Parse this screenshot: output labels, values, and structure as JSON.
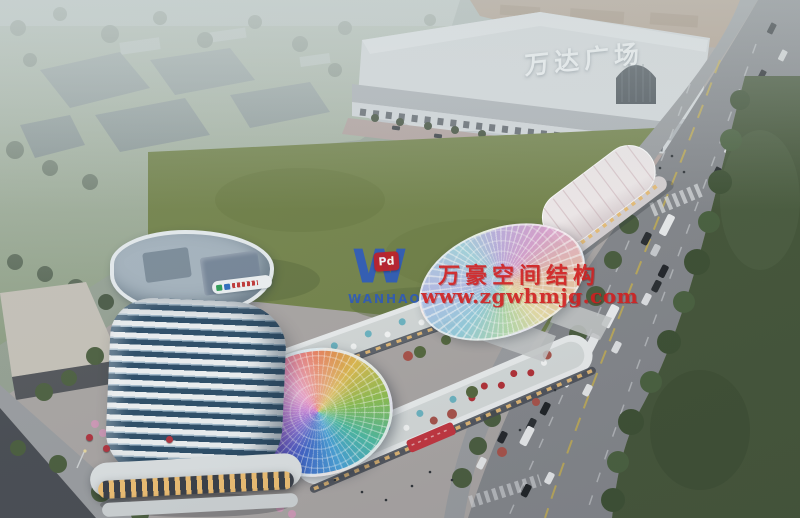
{
  "signage": {
    "wanda_plaza": "万达广场"
  },
  "watermark": {
    "logo_letter": "W",
    "logo_badge": "Pd",
    "brand": "WANHAO",
    "title": "万豪空间结构",
    "url": "www.zgwhmjg.com",
    "text_color": "#d11f1f",
    "logo_color": "#2757c8",
    "badge_color": "#c21f27"
  },
  "palette": {
    "lawn_green": "#75854d",
    "park_haze_green": "#8fa085",
    "road_gray": "#84878c",
    "roadside_green": "#45563a",
    "tower_glass_blue": "#2e4f6a",
    "tower_band_white": "#eef2f4",
    "wanda_facade": "#d9dde0",
    "wanda_roof_tan": "#b4a08e",
    "warm_shop_light": "#eec077",
    "dome_rainbow": [
      "#3f66c8",
      "#b450c8",
      "#e87a56",
      "#dcba50",
      "#8cbe52",
      "#4cbaa2"
    ]
  }
}
